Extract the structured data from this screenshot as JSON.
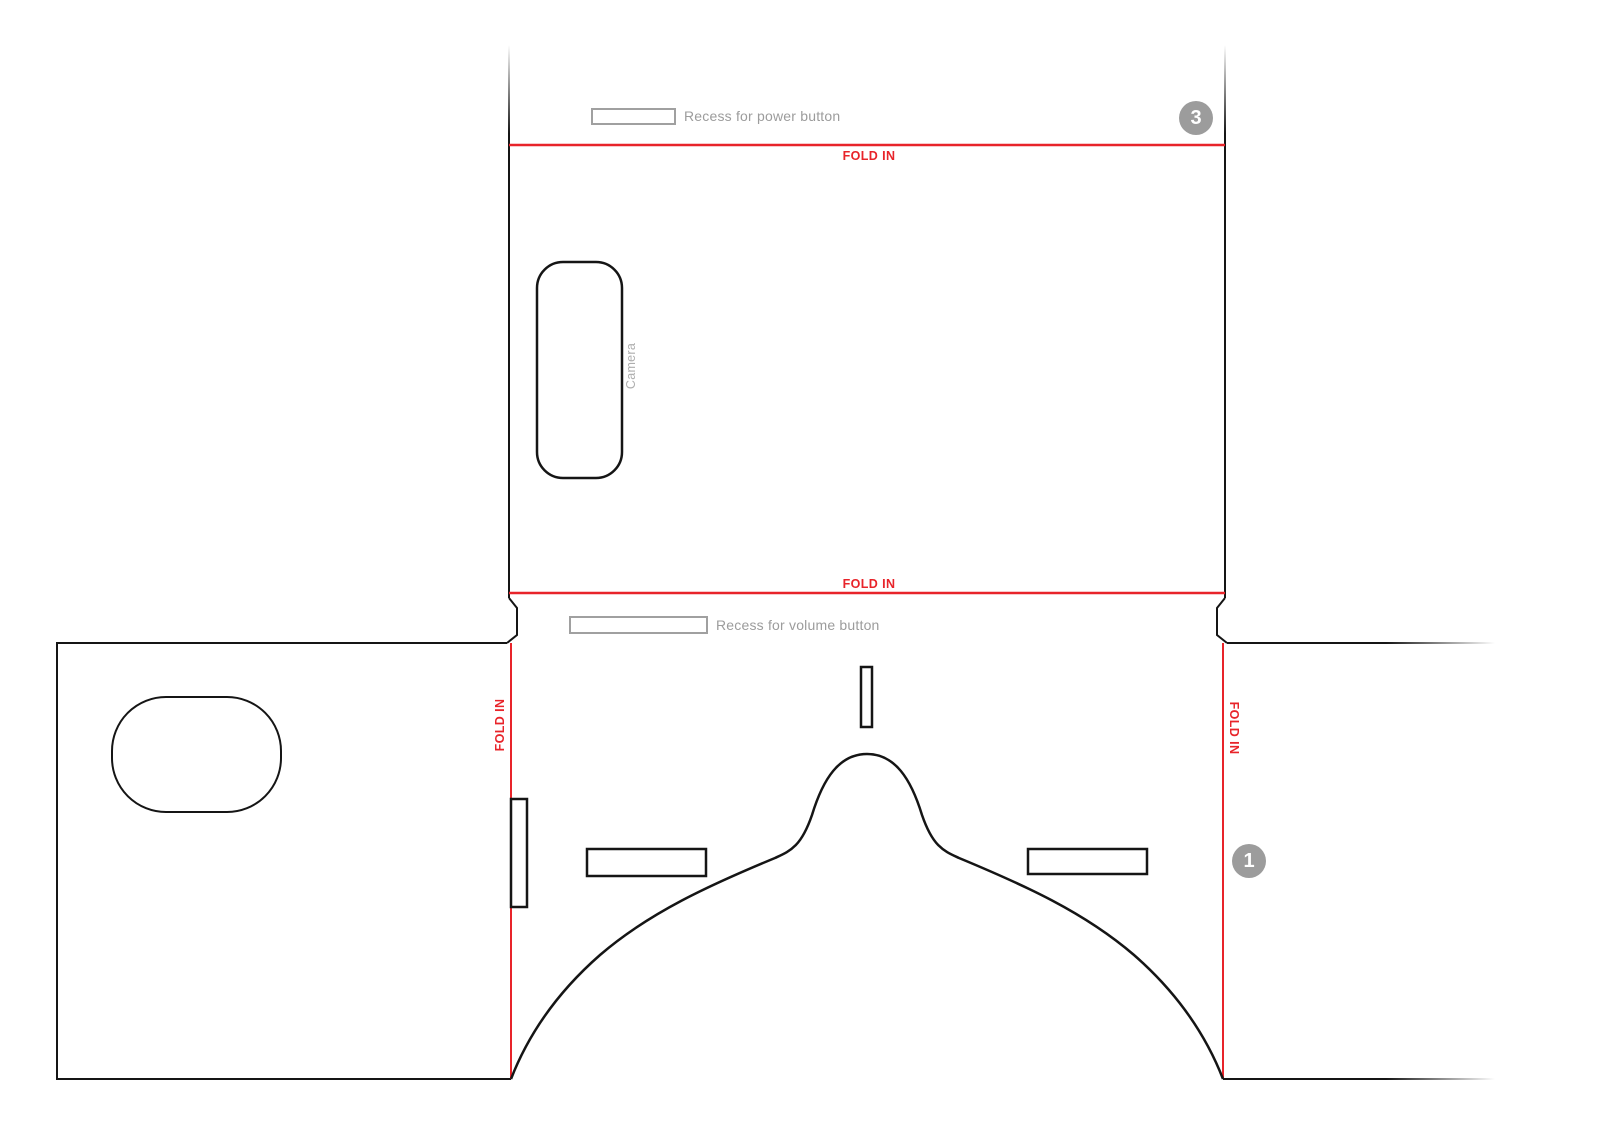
{
  "colors": {
    "fold_red": "#e8242a",
    "line_black": "#151515",
    "recess_gray": "#a0a0a0",
    "label_gray": "#9c9c9c",
    "badge_gray": "#9c9c9c"
  },
  "labels": {
    "fold_in": "FOLD IN",
    "power_recess": "Recess for power button",
    "volume_recess": "Recess for volume button",
    "camera": "Camera"
  },
  "badges": {
    "step_top": "3",
    "step_bottom": "1"
  }
}
